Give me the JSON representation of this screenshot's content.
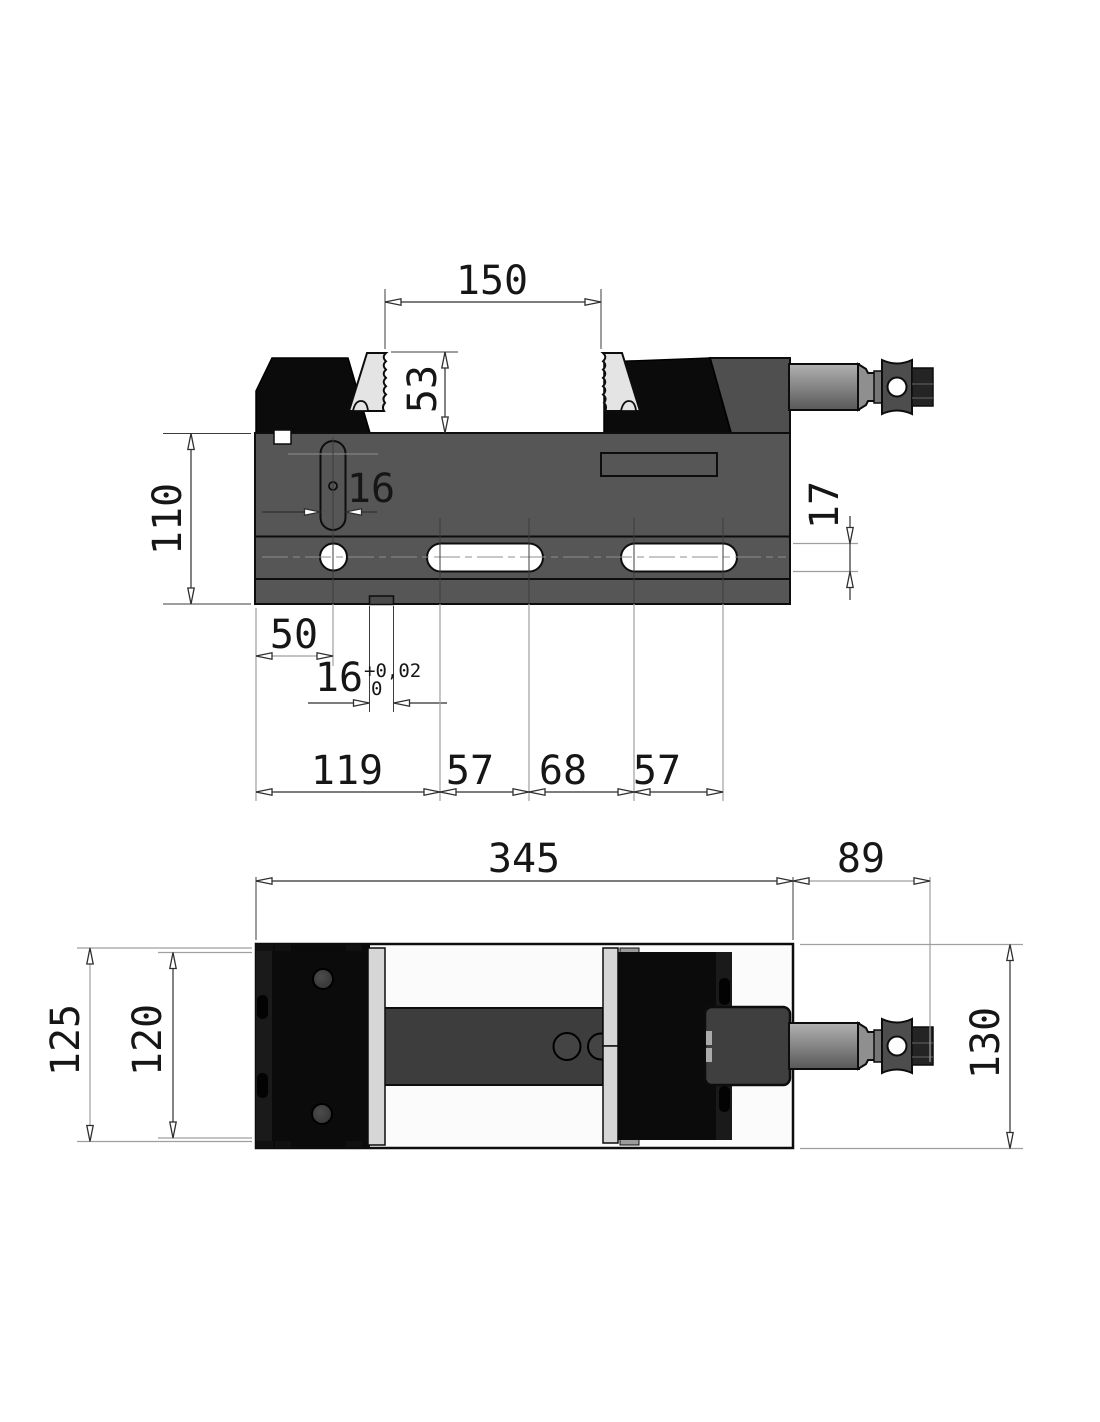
{
  "drawing": {
    "type": "CAD technical drawing - machine vise, two orthographic views",
    "side_view": {
      "jaw_opening": "150",
      "jaw_height": "53",
      "body_height": "110",
      "slot_width": "16",
      "t_slot_height": "17",
      "hole_offset": "50",
      "key_width": "16",
      "key_tol_upper": "+0,02",
      "key_tol_lower": "0",
      "chain": [
        "119",
        "57",
        "68",
        "57"
      ]
    },
    "plan_view": {
      "body_length": "345",
      "handle_length": "89",
      "base_width": "125",
      "jaw_plate_width": "120",
      "overall_width": "130"
    },
    "colors": {
      "body_gray": "#565656",
      "jaw_black": "#0b0b0b",
      "jaw_plate_light": "#e4e4e4",
      "slide_bar": "#3d3d3d",
      "dimension_line": "#2f2f2f",
      "background": "#ffffff"
    }
  }
}
